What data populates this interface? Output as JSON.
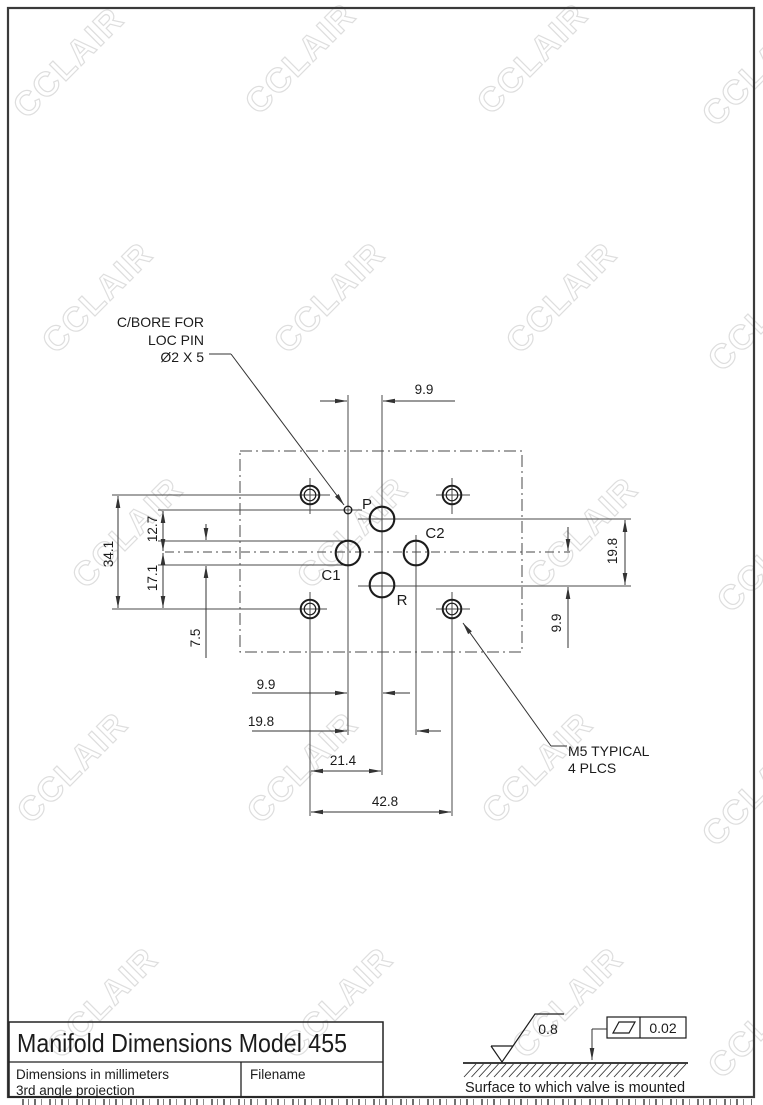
{
  "watermark": {
    "text": "CCLAIR"
  },
  "drawing": {
    "labels": {
      "p": "P",
      "c1": "C1",
      "c2": "C2",
      "r": "R"
    },
    "dimensions": {
      "top_width": "9.9",
      "left_overall": "34.1",
      "left_upper": "12.7",
      "left_lower": "17.1",
      "port_width": "7.5",
      "right_ports": "19.8",
      "right_lower": "9.9",
      "bottom_c1_center": "9.9",
      "bottom_c1_c2": "19.8",
      "bottom_bolt_center": "21.4",
      "bottom_bolt_span": "42.8"
    },
    "callouts": {
      "cbore_line1": "C/BORE FOR",
      "cbore_line2": "LOC PIN",
      "cbore_line3": "Ø2 X 5",
      "m5_line1": "M5 TYPICAL",
      "m5_line2": "4 PLCS"
    }
  },
  "finish": {
    "roughness": "0.8",
    "flatness": "0.02",
    "note": "Surface to which valve is mounted"
  },
  "title_block": {
    "title": "Manifold Dimensions Model 455",
    "note1": "Dimensions in millimeters",
    "note2": "3rd angle projection",
    "filename_label": "Filename"
  }
}
